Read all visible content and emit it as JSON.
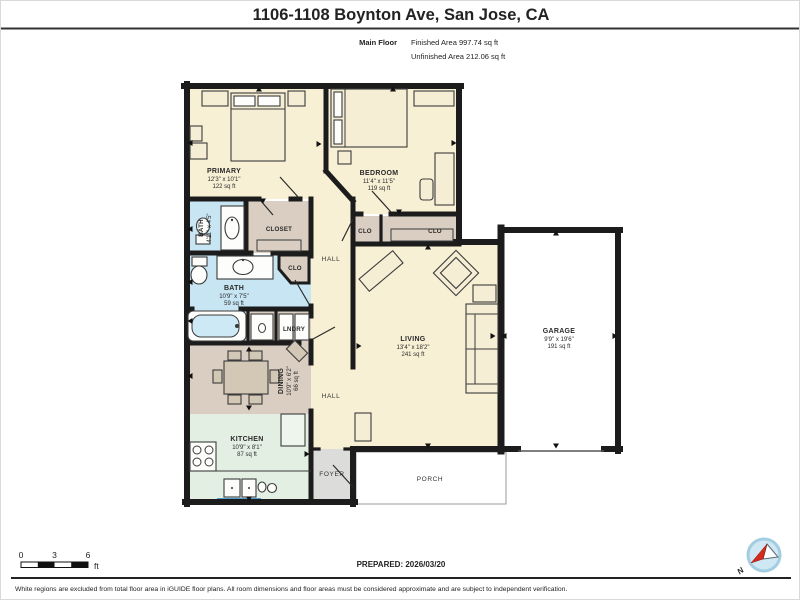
{
  "header": {
    "title": "1106-1108 Boynton Ave, San Jose, CA",
    "floor_label": "Main Floor",
    "finished_area": "Finished Area 997.74 sq ft",
    "unfinished_area": "Unfinished Area 212.06 sq ft"
  },
  "rooms": {
    "primary": {
      "name": "PRIMARY",
      "dims": "12'3\" x 10'1\"",
      "area": "122 sq ft"
    },
    "bedroom": {
      "name": "BEDROOM",
      "dims": "11'4\" x 11'5\"",
      "area": "119 sq ft"
    },
    "bath_small": {
      "name": "BATH",
      "dims": "4'11\" x 4'5\""
    },
    "closet": {
      "name": "CLOSET"
    },
    "clo_hall": {
      "name": "CLO"
    },
    "bath_main": {
      "name": "BATH",
      "dims": "10'9\" x 7'5\"",
      "area": "59 sq ft"
    },
    "lndry": {
      "name": "LNDRY"
    },
    "dining": {
      "name": "DINING",
      "dims": "10'9\" x 6'2\"",
      "area": "66 sq ft"
    },
    "kitchen": {
      "name": "KITCHEN",
      "dims": "10'9\" x 8'1\"",
      "area": "87 sq ft"
    },
    "hall_upper": {
      "name": "HALL"
    },
    "hall_lower": {
      "name": "HALL"
    },
    "living": {
      "name": "LIVING",
      "dims": "13'4\" x 18'2\"",
      "area": "241 sq ft"
    },
    "garage": {
      "name": "GARAGE",
      "dims": "9'9\" x 19'6\"",
      "area": "191 sq ft"
    },
    "clo_bed_left": {
      "name": "CLO"
    },
    "clo_bed_right": {
      "name": "CLO"
    },
    "foyer": {
      "name": "FOYER"
    },
    "porch": {
      "name": "PORCH"
    }
  },
  "scale_bar": {
    "tick_0": "0",
    "tick_3": "3",
    "tick_6": "6",
    "unit": "ft"
  },
  "footer": {
    "prepared": "PREPARED: 2026/03/20",
    "disclaimer": "White regions are excluded from total floor area in iGUIDE floor plans. All room dimensions and floor areas must be considered approximate and are subject to independent verification.",
    "compass_north": "N"
  },
  "colors": {
    "wall": "#1c1c1c",
    "room_fill": "#f8f0d5",
    "wet_room_fill": "#c7e5f2",
    "closet_fill": "#d9cec1",
    "kitchen_fill": "#e3efe2",
    "foyer_fill": "#dcdcda",
    "window": "#4d9fd2",
    "compass_red": "#d42b1e"
  }
}
